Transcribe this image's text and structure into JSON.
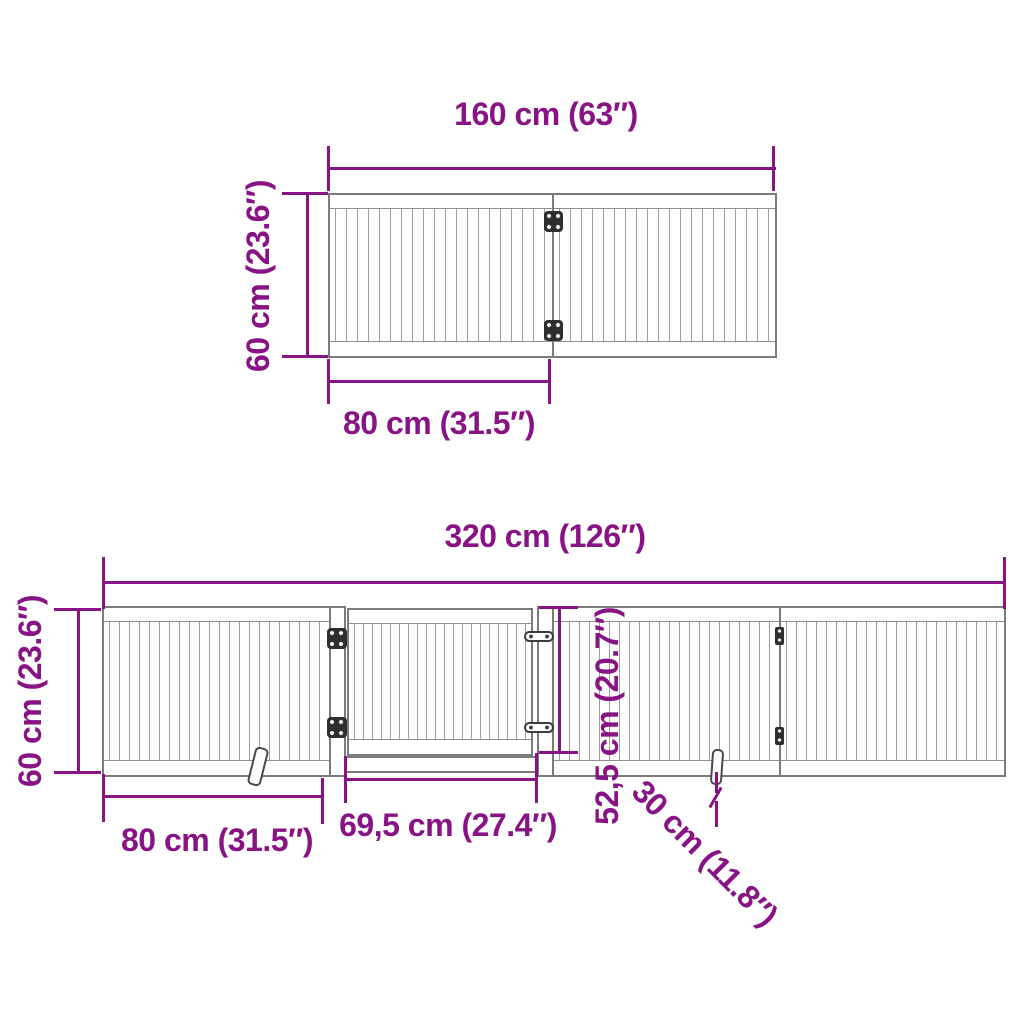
{
  "diagram": {
    "type": "product-dimension-drawing",
    "subject": "foldable multi-panel pet gate with door",
    "colors": {
      "dimension": "#871385",
      "outline": "#7b7b7b",
      "background": "#ffffff"
    },
    "top_drawing": {
      "description": "2-panel gate, top view",
      "total_width_label": "160 cm (63″)",
      "height_label": "60 cm (23.6″)",
      "panel_width_label": "80 cm (31.5″)",
      "total_width_cm": 160,
      "height_cm": 60,
      "panel_width_cm": 80
    },
    "bottom_drawing": {
      "description": "4-section gate with hinged door, front view",
      "total_width_label": "320 cm (126″)",
      "height_label": "60 cm (23.6″)",
      "panel_width_label": "80 cm (31.5″)",
      "door_width_label": "69,5 cm (27.4″)",
      "door_height_label": "52,5 cm (20.7″)",
      "foot_depth_label": "30 cm (11.8″)",
      "total_width_cm": 320,
      "height_cm": 60,
      "panel_width_cm": 80,
      "door_width_cm": 69.5,
      "door_height_cm": 52.5,
      "foot_depth_cm": 30
    }
  }
}
